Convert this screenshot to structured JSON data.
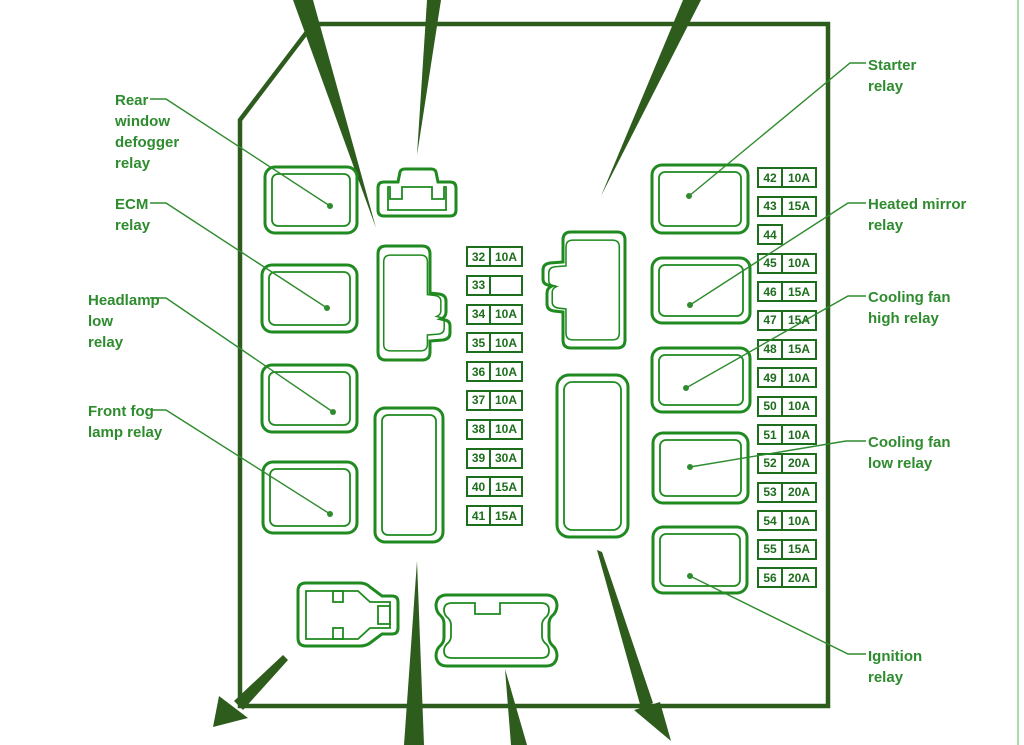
{
  "diagram_title": "Fuse box relay diagram",
  "palette": {
    "label_green": "#2e8b2e",
    "line_green": "#1f8a1f",
    "fuse_green": "#1c6e1c",
    "dark_green": "#2e5c1d",
    "edge_light_green": "#90d890"
  },
  "labels": {
    "left_items": [
      {
        "text": "Rear\nwindow\ndefogger\nrelay"
      },
      {
        "text": "ECM\nrelay"
      },
      {
        "text": "Headlamp\nlow\nrelay"
      },
      {
        "text": "Front fog\nlamp relay"
      }
    ],
    "right_items": [
      {
        "text": "Starter\nrelay"
      },
      {
        "text": "Heated mirror\nrelay"
      },
      {
        "text": "Cooling fan\nhigh relay"
      },
      {
        "text": "Cooling fan\nlow relay"
      },
      {
        "text": "Ignition\nrelay"
      }
    ]
  },
  "fuses": {
    "center_column": [
      {
        "id": "32",
        "amp": "10A"
      },
      {
        "id": "33",
        "amp": ""
      },
      {
        "id": "34",
        "amp": "10A"
      },
      {
        "id": "35",
        "amp": "10A"
      },
      {
        "id": "36",
        "amp": "10A"
      },
      {
        "id": "37",
        "amp": "10A"
      },
      {
        "id": "38",
        "amp": "10A"
      },
      {
        "id": "39",
        "amp": "30A"
      },
      {
        "id": "40",
        "amp": "15A"
      },
      {
        "id": "41",
        "amp": "15A"
      }
    ],
    "right_column": [
      {
        "id": "42",
        "amp": "10A"
      },
      {
        "id": "43",
        "amp": "15A"
      },
      {
        "id": "44",
        "amp": null
      },
      {
        "id": "45",
        "amp": "10A"
      },
      {
        "id": "46",
        "amp": "15A"
      },
      {
        "id": "47",
        "amp": "15A"
      },
      {
        "id": "48",
        "amp": "15A"
      },
      {
        "id": "49",
        "amp": "10A"
      },
      {
        "id": "50",
        "amp": "10A"
      },
      {
        "id": "51",
        "amp": "10A"
      },
      {
        "id": "52",
        "amp": "20A"
      },
      {
        "id": "53",
        "amp": "20A"
      },
      {
        "id": "54",
        "amp": "10A"
      },
      {
        "id": "55",
        "amp": "15A"
      },
      {
        "id": "56",
        "amp": "20A"
      }
    ]
  }
}
